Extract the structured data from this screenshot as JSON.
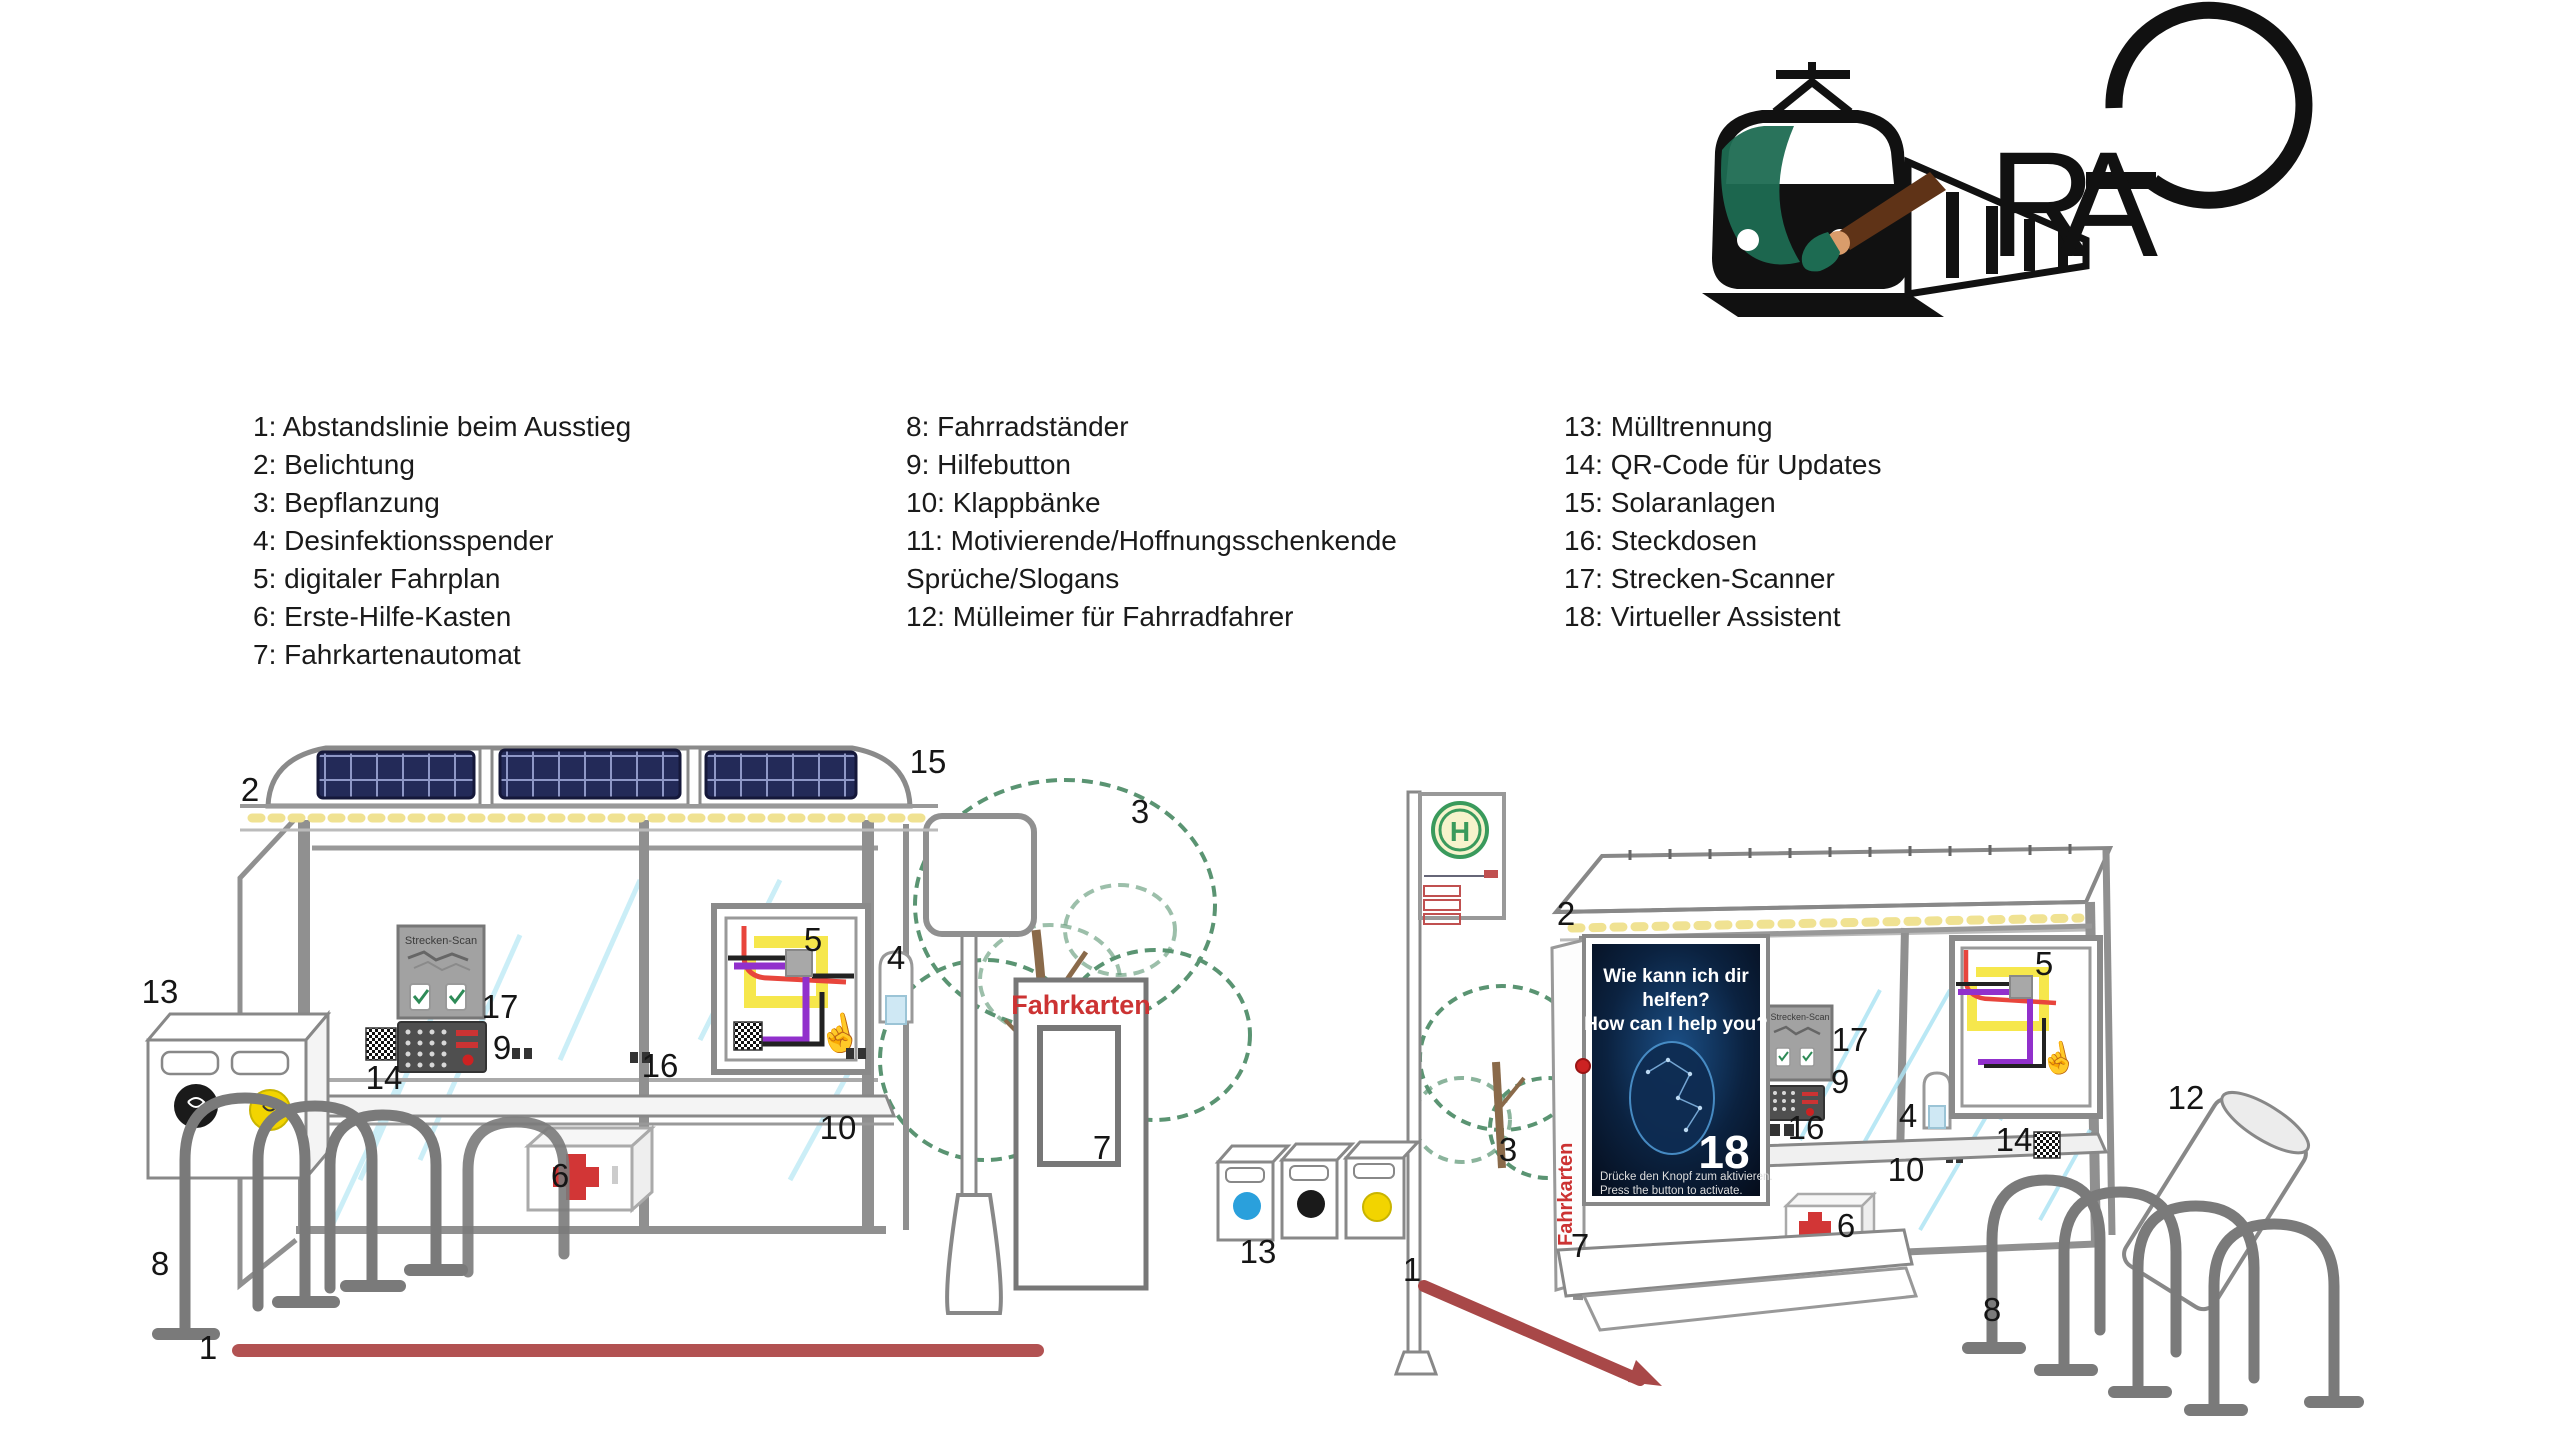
{
  "legend": {
    "columns": [
      {
        "items": [
          "1: Abstandslinie beim Ausstieg",
          "2: Belichtung",
          "3: Bepflanzung",
          "4: Desinfektionsspender",
          "5: digitaler Fahrplan",
          "6: Erste-Hilfe-Kasten",
          "7: Fahrkartenautomat"
        ]
      },
      {
        "items": [
          "8: Fahrradständer",
          "9: Hilfebutton",
          "10: Klappbänke",
          "11: Motivierende/Hoffnungsschenkende Sprüche/Slogans",
          "12: Mülleimer für Fahrradfahrer"
        ]
      },
      {
        "items": [
          "13: Mülltrennung",
          "14: QR-Code für Updates",
          "15: Solaranlagen",
          "16: Steckdosen",
          "17: Strecken-Scanner",
          "18: Virtueller Assistent"
        ]
      }
    ]
  },
  "logos": {
    "train_icon": "train-with-paintbrush",
    "monogram": {
      "r": "R",
      "a": "A"
    }
  },
  "scene": {
    "hand_icon": "☝",
    "left_shelter": {
      "strecken_scan": "Strecken-Scan"
    },
    "left_ticket_machine": {
      "fahrkarten": "Fahrkarten"
    },
    "right_bus_sign": {
      "h": "H"
    },
    "right_kiosk": {
      "fahrkarten": "Fahrkarten",
      "assistant_line1": "Wie kann ich dir",
      "assistant_line2": "helfen?",
      "assistant_line3": "How can I help you?",
      "assistant_note_de": "Drücke den Knopf zum aktivieren.",
      "assistant_note_en": "Press the button to activate."
    },
    "right_shelter": {
      "strecken_scan": "Strecken-Scan"
    },
    "callouts": [
      {
        "n": "2",
        "x": 250,
        "y": 790
      },
      {
        "n": "15",
        "x": 928,
        "y": 762
      },
      {
        "n": "3",
        "x": 1140,
        "y": 812
      },
      {
        "n": "4",
        "x": 896,
        "y": 958
      },
      {
        "n": "5",
        "x": 813,
        "y": 940
      },
      {
        "n": "17",
        "x": 500,
        "y": 1007
      },
      {
        "n": "9",
        "x": 502,
        "y": 1048
      },
      {
        "n": "14",
        "x": 384,
        "y": 1078
      },
      {
        "n": "16",
        "x": 660,
        "y": 1066
      },
      {
        "n": "10",
        "x": 838,
        "y": 1128
      },
      {
        "n": "6",
        "x": 560,
        "y": 1176
      },
      {
        "n": "13",
        "x": 160,
        "y": 992
      },
      {
        "n": "8",
        "x": 160,
        "y": 1264
      },
      {
        "n": "1",
        "x": 208,
        "y": 1348
      },
      {
        "n": "7",
        "x": 1102,
        "y": 1148
      },
      {
        "n": "2",
        "x": 1566,
        "y": 914
      },
      {
        "n": "18",
        "x": 1724,
        "y": 1152,
        "light": true,
        "size": 46
      },
      {
        "n": "3",
        "x": 1508,
        "y": 1150
      },
      {
        "n": "13",
        "x": 1258,
        "y": 1252
      },
      {
        "n": "1",
        "x": 1412,
        "y": 1270
      },
      {
        "n": "7",
        "x": 1580,
        "y": 1246
      },
      {
        "n": "17",
        "x": 1850,
        "y": 1040
      },
      {
        "n": "9",
        "x": 1840,
        "y": 1082
      },
      {
        "n": "16",
        "x": 1806,
        "y": 1128
      },
      {
        "n": "4",
        "x": 1908,
        "y": 1116
      },
      {
        "n": "10",
        "x": 1906,
        "y": 1170
      },
      {
        "n": "6",
        "x": 1846,
        "y": 1226
      },
      {
        "n": "5",
        "x": 2044,
        "y": 964
      },
      {
        "n": "14",
        "x": 2014,
        "y": 1140
      },
      {
        "n": "12",
        "x": 2186,
        "y": 1098
      },
      {
        "n": "8",
        "x": 1992,
        "y": 1310
      }
    ]
  },
  "colors": {
    "distance_line_red": "#b25252",
    "fahrkarten_red": "#cc3333",
    "solar_navy": "#232a58",
    "led_yellow": "#f0e292",
    "first_aid_cross": "#d23636",
    "h_sign_green": "#3a9a5c",
    "assistant_screen_blue": "#0b2240",
    "bin_sticker_blue": "#2aa0dc",
    "bin_sticker_yellow": "#f2d400",
    "bin_sticker_black": "#1a1a1a",
    "tree_green": "#5a9472",
    "route_red": "#e8453c",
    "route_yellow": "#f5e642",
    "route_purple": "#9130cc",
    "frame_grey": "#8a8a8a"
  }
}
